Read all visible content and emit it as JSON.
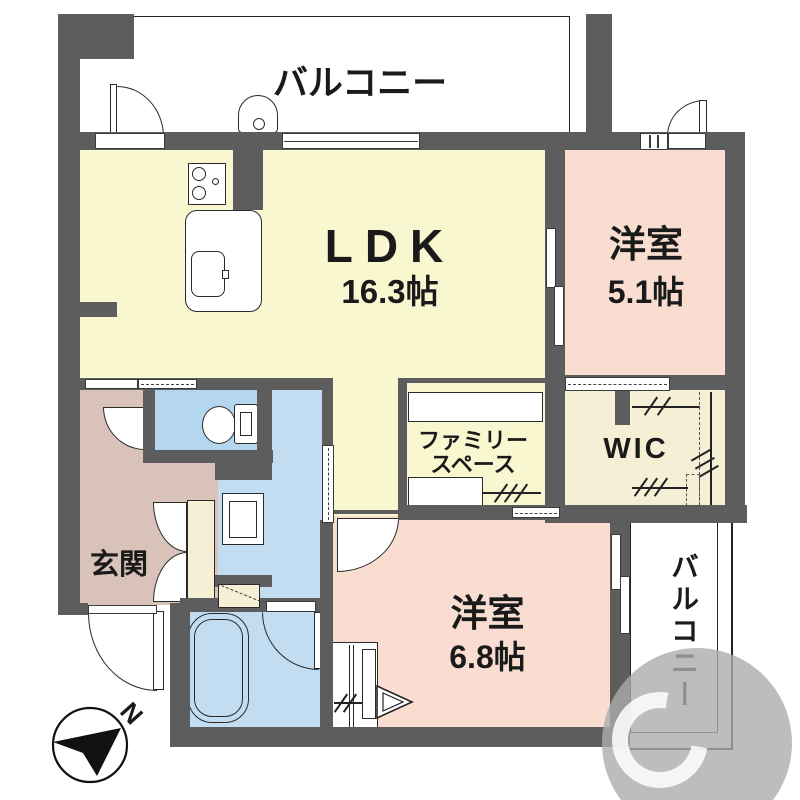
{
  "floorplan": {
    "balcony_top": {
      "label": "バルコニー"
    },
    "balcony_right": {
      "label": "バルコニー"
    },
    "ldk": {
      "label": "LDK",
      "size": "16.3帖"
    },
    "bedroom_right": {
      "label": "洋室",
      "size": "5.1帖"
    },
    "bedroom_bottom": {
      "label": "洋室",
      "size": "6.8帖"
    },
    "family_space": {
      "line1": "ファミリー",
      "line2": "スペース"
    },
    "wic": {
      "label": "WIC"
    },
    "entrance": {
      "label": "玄関"
    },
    "compass": {
      "north": "N"
    },
    "colors": {
      "wall": "#5d5d5d",
      "ldk_floor": "#f8f7d0",
      "bedroom_floor": "#f8ddd0",
      "entrance_floor": "#d8c2b9",
      "toilet": "#b5d6ef",
      "wet_area": "#c2ddf2",
      "closet": "#f4efd5"
    }
  }
}
